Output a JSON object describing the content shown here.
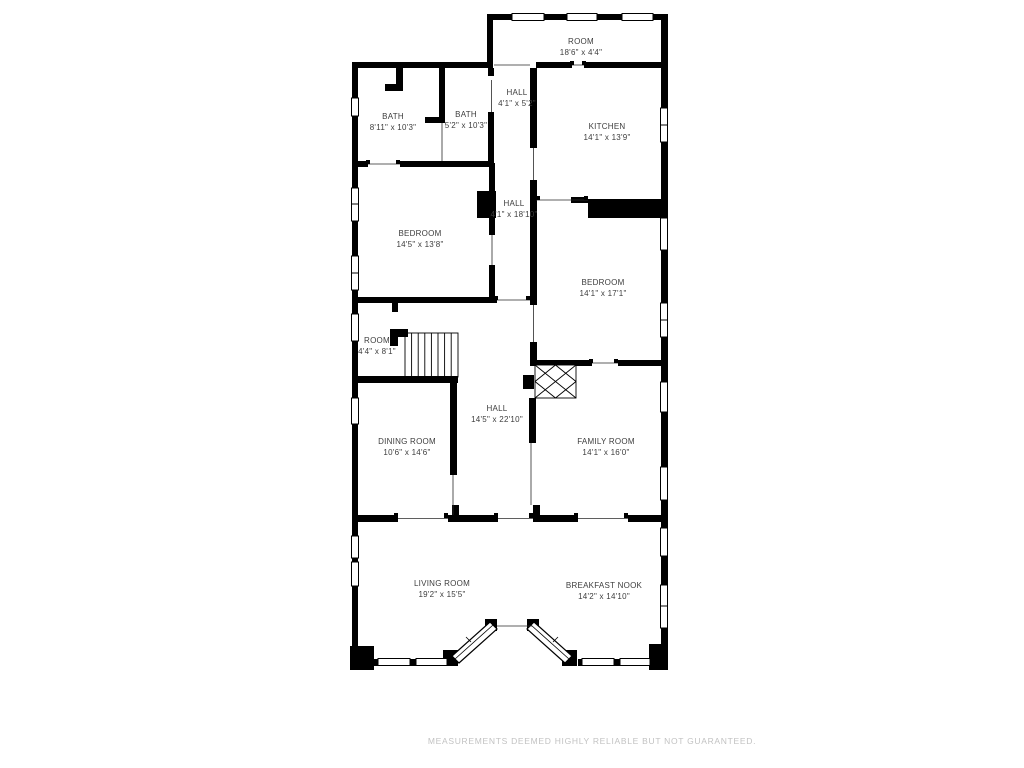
{
  "page": {
    "disclaimer": "MEASUREMENTS DEEMED HIGHLY RELIABLE BUT NOT GUARANTEED."
  },
  "floorplan": {
    "colors": {
      "wall": "#000000",
      "label": "#3d3d3d",
      "disclaimer": "#c2c2c2",
      "background": "#ffffff"
    },
    "rooms": [
      {
        "id": "room-top",
        "name": "ROOM",
        "dims": "18'6\" x 4'4\""
      },
      {
        "id": "hall-upper",
        "name": "HALL",
        "dims": "4'1\" x 5'2\""
      },
      {
        "id": "bath-large",
        "name": "BATH",
        "dims": "8'11\" x 10'3\""
      },
      {
        "id": "bath-small",
        "name": "BATH",
        "dims": "5'2\" x 10'3\""
      },
      {
        "id": "kitchen",
        "name": "KITCHEN",
        "dims": "14'1\" x 13'9\""
      },
      {
        "id": "hall-mid",
        "name": "HALL",
        "dims": "4'1\" x 18'10\""
      },
      {
        "id": "bedroom-left",
        "name": "BEDROOM",
        "dims": "14'5\" x 13'8\""
      },
      {
        "id": "bedroom-right",
        "name": "BEDROOM",
        "dims": "14'1\" x 17'1\""
      },
      {
        "id": "room-small",
        "name": "ROOM",
        "dims": "4'4\" x 8'1\""
      },
      {
        "id": "hall-main",
        "name": "HALL",
        "dims": "14'5\" x 22'10\""
      },
      {
        "id": "dining-room",
        "name": "DINING ROOM",
        "dims": "10'6\" x 14'6\""
      },
      {
        "id": "family-room",
        "name": "FAMILY ROOM",
        "dims": "14'1\" x 16'0\""
      },
      {
        "id": "living-room",
        "name": "LIVING ROOM",
        "dims": "19'2\" x 15'5\""
      },
      {
        "id": "breakfast-nook",
        "name": "BREAKFAST NOOK",
        "dims": "14'2\" x 14'10\""
      }
    ]
  }
}
